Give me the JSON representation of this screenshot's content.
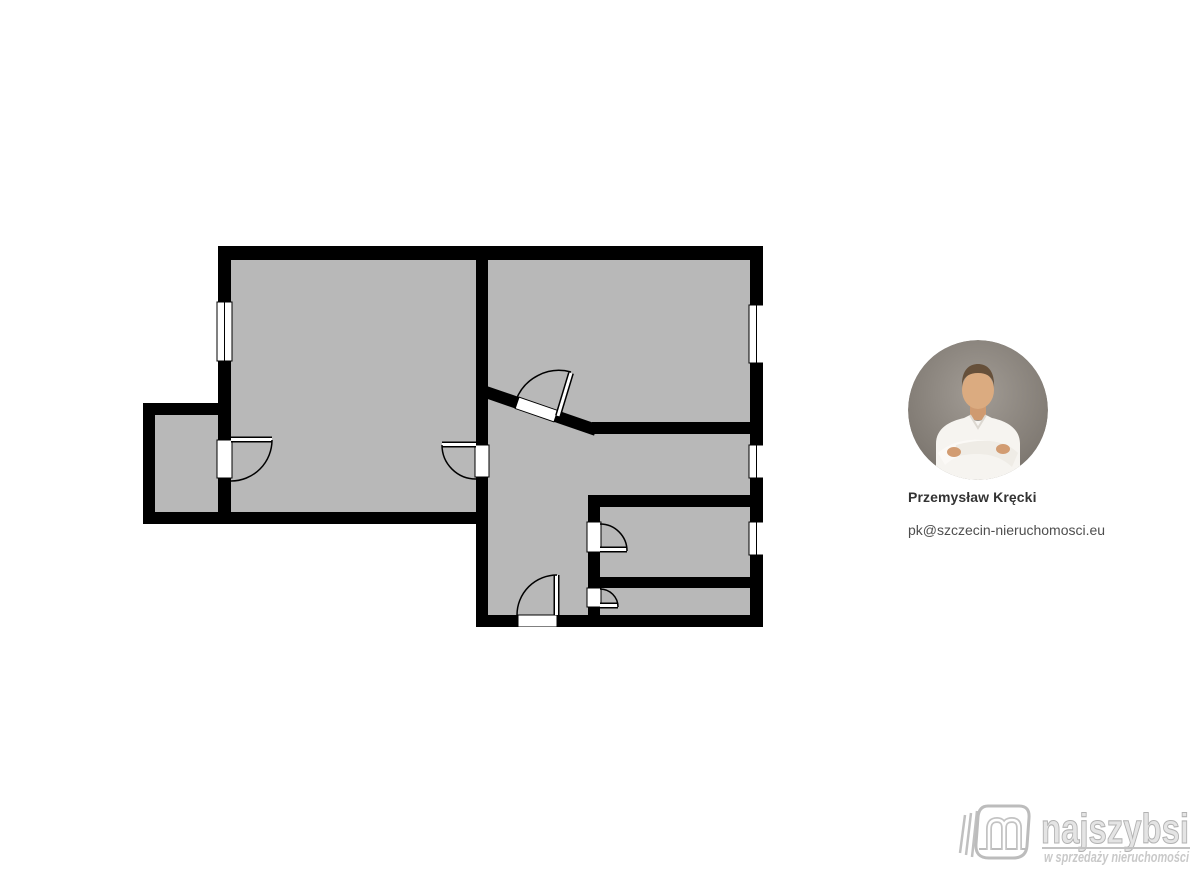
{
  "canvas": {
    "width": 1200,
    "height": 878,
    "background": "#ffffff"
  },
  "agent": {
    "name": "Przemysław Kręcki",
    "email": "pk@szczecin-nieruchomosci.eu",
    "photo": "man-in-white-shirt-arms-crossed-portrait"
  },
  "logo": {
    "brand": "najszybsi",
    "tagline": "w sprzedaży nieruchomości",
    "color": "#c6c6c6"
  },
  "floorplan": {
    "position": {
      "left": 143,
      "top": 246,
      "width": 620,
      "height": 381
    },
    "colors": {
      "wall": "#000000",
      "floor": "#b8b8b8",
      "opening": "#ffffff"
    },
    "floor_areas": [
      [
        143,
        403,
        88,
        121
      ],
      [
        218,
        246,
        270,
        278
      ],
      [
        476,
        246,
        287,
        188
      ],
      [
        476,
        380,
        287,
        247
      ]
    ],
    "walls": [
      [
        218,
        246,
        545,
        14
      ],
      [
        218,
        246,
        13,
        278
      ],
      [
        750,
        246,
        13,
        381
      ],
      [
        476,
        615,
        287,
        12
      ],
      [
        143,
        512,
        345,
        12
      ],
      [
        143,
        403,
        12,
        121
      ],
      [
        143,
        403,
        88,
        12
      ],
      [
        476,
        246,
        12,
        199
      ],
      [
        476,
        477,
        12,
        150
      ],
      [
        592,
        422,
        158,
        12
      ],
      [
        588,
        495,
        175,
        12
      ],
      [
        588,
        495,
        12,
        27
      ],
      [
        588,
        552,
        12,
        36
      ],
      [
        588,
        607,
        12,
        20
      ],
      [
        588,
        577,
        175,
        11
      ]
    ],
    "diagonal_wall": {
      "x1": 480,
      "y1": 390,
      "x2": 596,
      "y2": 430,
      "thickness": 12
    },
    "diagonal_opening": {
      "cx": 536.5,
      "cy": 409.5,
      "w": 41,
      "h": 12,
      "angle": 19
    },
    "windows": [
      {
        "x": 217,
        "y": 302,
        "w": 15,
        "h": 59
      },
      {
        "x": 749,
        "y": 305,
        "w": 15,
        "h": 58
      },
      {
        "x": 749,
        "y": 445,
        "w": 15,
        "h": 33
      },
      {
        "x": 749,
        "y": 522,
        "w": 15,
        "h": 33
      }
    ],
    "door_openings": [
      {
        "x": 217,
        "y": 440,
        "w": 15,
        "h": 38
      },
      {
        "x": 475,
        "y": 445,
        "w": 14,
        "h": 32
      },
      {
        "x": 587,
        "y": 522,
        "w": 14,
        "h": 30
      },
      {
        "x": 587,
        "y": 588,
        "w": 14,
        "h": 19
      },
      {
        "x": 518,
        "y": 615,
        "w": 39,
        "h": 12
      }
    ],
    "door_leaves": [
      {
        "x1": 231,
        "y1": 439.5,
        "x2": 272,
        "y2": 439.5
      },
      {
        "x1": 476,
        "y1": 444.5,
        "x2": 442,
        "y2": 444.5
      },
      {
        "x1": 600,
        "y1": 549.5,
        "x2": 627,
        "y2": 549.5
      },
      {
        "x1": 600,
        "y1": 605.5,
        "x2": 618,
        "y2": 605.5
      },
      {
        "x1": 556.5,
        "y1": 615,
        "x2": 556.5,
        "y2": 575
      },
      {
        "x1": 558,
        "y1": 416,
        "x2": 571,
        "y2": 373
      }
    ],
    "door_arcs": [
      "M272,440 A41,41 0 0 1 231,481",
      "M442,445 A34,34 0 0 0 476,479",
      "M627,551 A27,27 0 0 0 600,524",
      "M618,607 A18,18 0 0 0 600,589",
      "M557,575 A40,40 0 0 0 517,615",
      "M571,372 A46,46 0 0 0 516,400"
    ]
  }
}
